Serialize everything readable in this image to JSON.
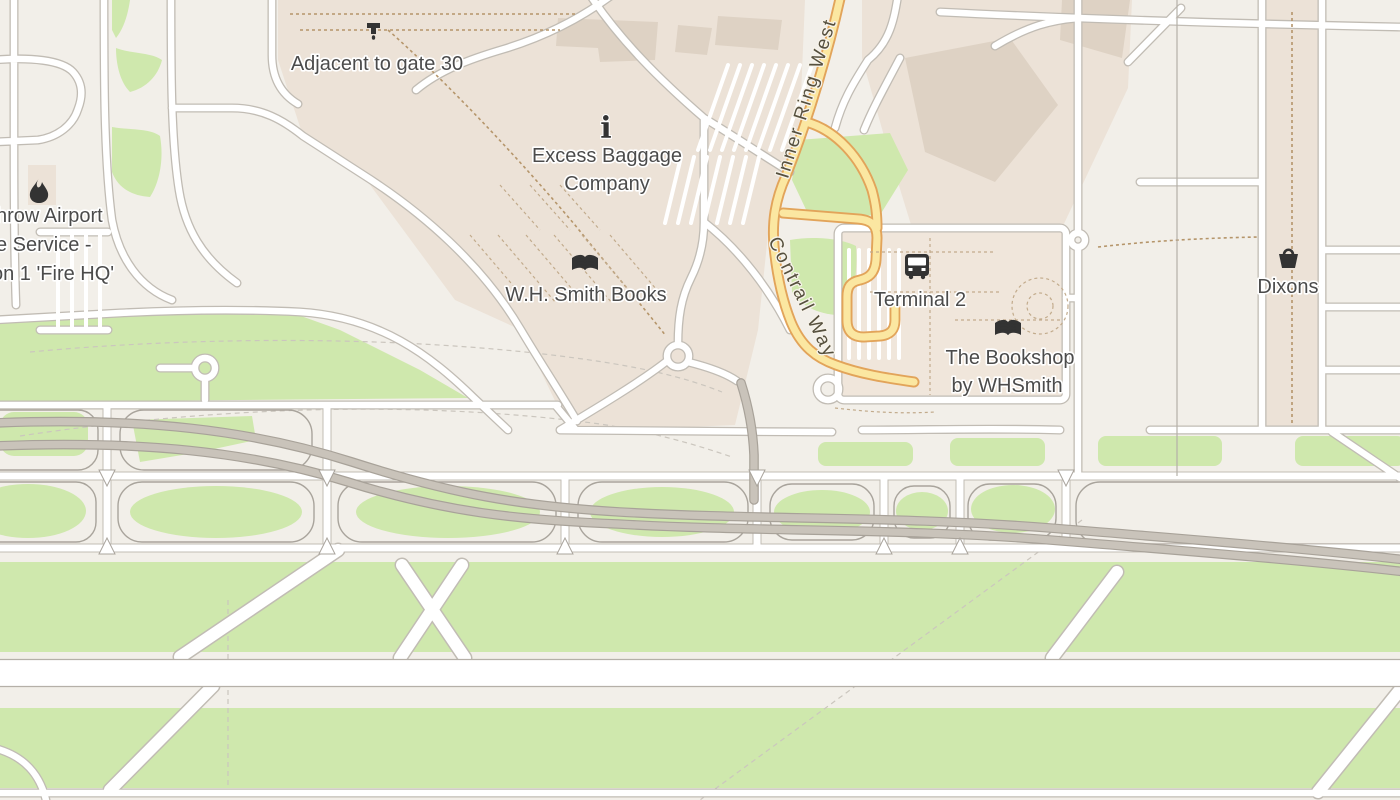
{
  "colors": {
    "land": "#f2efe9",
    "apron": "#ece2d7",
    "building": "#ded2c4",
    "terminal_block": "#f0e6db",
    "grass": "#cfe8ad",
    "road_fill": "#ffffff",
    "road_casing": "#c1bcb4",
    "cell_outline": "#a9a49c",
    "gray_road": "#c9c3ba",
    "gray_road_casing": "#a8a299",
    "primary_fill": "#fbe7a1",
    "primary_casing": "#e2a45a",
    "path_brown": "#b5956a",
    "path_brown2": "#c2ab8c",
    "faint_line": "#cbc6be",
    "boundary_line": "#b5b0a8",
    "poi_text": "#4b4b4b",
    "road_text": "#56503e",
    "icon_color": "#333333"
  },
  "poi_labels": {
    "fire_station": {
      "icon": "fire-icon",
      "line1": "hrow Airport",
      "line2": "e Service -",
      "line3": "on 1 'Fire HQ'"
    },
    "water_point": {
      "icon": "drinking-water-icon",
      "line1": "Adjacent to gate 30"
    },
    "excess_baggage": {
      "icon": "information-icon",
      "line1": "Excess Baggage",
      "line2": "Company"
    },
    "wh_smith_books": {
      "icon": "book-icon",
      "line1": "W.H. Smith Books"
    },
    "terminal_2": {
      "icon": "bus-stop-icon",
      "line1": "Terminal 2"
    },
    "bookshop_whsmith": {
      "icon": "book-icon",
      "line1": "The Bookshop",
      "line2": "by WHSmith"
    },
    "dixons": {
      "icon": "shop-basket-icon",
      "line1": "Dixons"
    }
  },
  "road_labels": {
    "inner_ring_west": "Inner Ring West",
    "contrail_way": "Contrail Way"
  },
  "glyphs": {
    "information": "i"
  }
}
